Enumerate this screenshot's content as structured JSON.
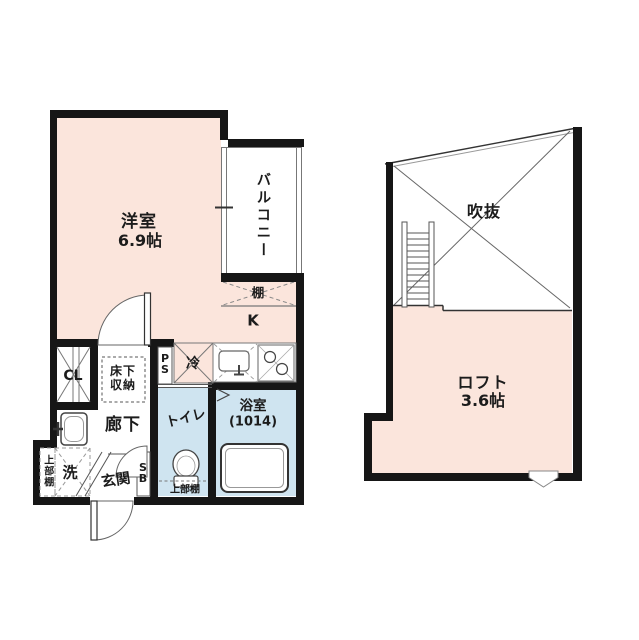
{
  "figure": "apartment-floor-plan",
  "colors": {
    "room_pink": "#fbe5dc",
    "wet_area_blue": "#cfe4f0",
    "wall_black": "#161616"
  },
  "plan_main": {
    "rooms": {
      "western_room_name": "洋室",
      "western_room_size": "6.9帖",
      "balcony": "バルコニー",
      "shelf": "棚",
      "kitchen": "K",
      "fridge": "冷",
      "pipe_space": "PS",
      "closet": "CL",
      "underfloor_storage": "床下収納",
      "hallway": "廊下",
      "toilet": "トイレ",
      "bathroom_name": "浴室",
      "bathroom_size": "(1014)",
      "washer": "洗",
      "upper_shelf_left": "上部棚",
      "entrance": "玄関",
      "shoe_box": "SB",
      "upper_shelf_toilet": "上部棚"
    }
  },
  "plan_loft": {
    "void_label": "吹抜",
    "loft_name": "ロフト",
    "loft_size": "3.6帖"
  }
}
